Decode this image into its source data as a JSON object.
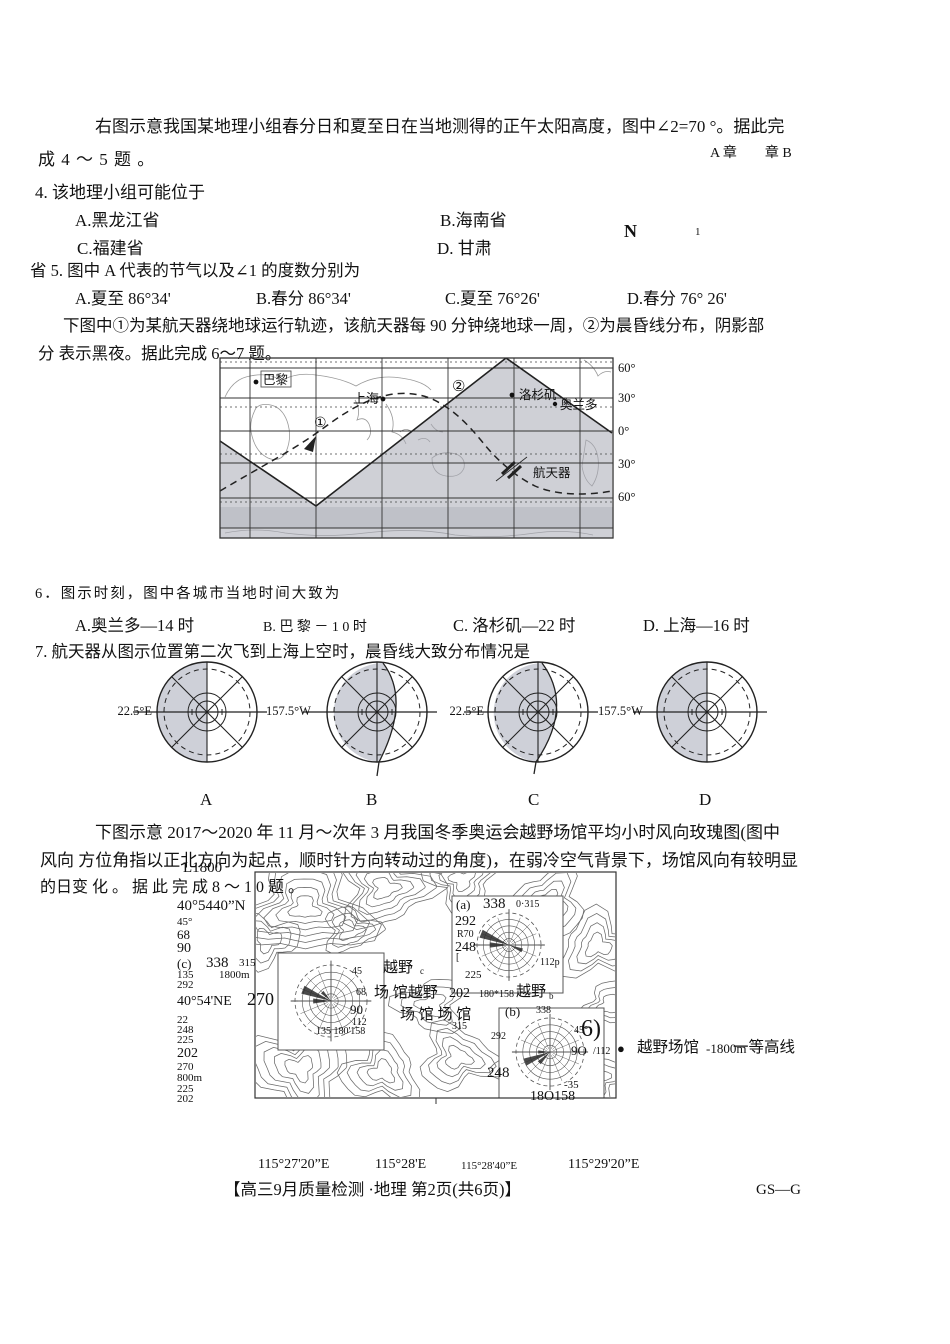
{
  "intro45": {
    "line1": "右图示意我国某地理小组春分日和夏至日在当地测得的正午太阳高度，图中∠2=70 °。据此完",
    "line2": "成 4 ～ 5 题 。"
  },
  "remnants": {
    "ab": "A 章　　章 B",
    "n": "N",
    "one": "1"
  },
  "q4": {
    "stem": "4. 该地理小组可能位于",
    "a": "A.黑龙江省",
    "b": "B.海南省",
    "c": "C.福建省",
    "d": "D. 甘肃"
  },
  "q5": {
    "stem": "省 5. 图中 A 代表的节气以及∠1 的度数分别为",
    "a": "A.夏至   86°34'",
    "b": "B.春分   86°34'",
    "c": "C.夏至   76°26'",
    "d": "D.春分 76° 26'"
  },
  "intro67": {
    "line1": "下图中①为某航天器绕地球运行轨迹，该航天器每 90 分钟绕地球一周，②为晨昏线分布，阴影部",
    "line2": "分 表示黑夜。据此完成 6～7 题。"
  },
  "worldmap": {
    "lat": [
      "60°",
      "30°",
      "0°",
      "30°",
      "60°"
    ],
    "paris": "巴黎",
    "shanghai": "上海",
    "la": "洛杉矶",
    "orlando": "奥兰多",
    "craft": "航天器",
    "m1": "①",
    "m2": "②"
  },
  "q6": {
    "stem": "6．图示时刻，图中各城市当地时间大致为",
    "a": "A.奥兰多—14 时",
    "b": "B. 巴 黎 － 1 0 时",
    "c": "C. 洛杉矶—22 时",
    "d": "D. 上海—16 时"
  },
  "q7": {
    "stem": "7. 航天器从图示位置第二次飞到上海上空时，晨昏线大致分布情况是",
    "opts": [
      {
        "lon": "22.5°E",
        "letter": "A"
      },
      {
        "lon": "157.5°W",
        "letter": "B"
      },
      {
        "lon": "22.5°E",
        "letter": "C"
      },
      {
        "lon": "157.5°W",
        "letter": "D"
      }
    ]
  },
  "intro810": {
    "line1": "下图示意 2017～2020 年 11 月～次年 3 月我国冬季奥运会越野场馆平均小时风向玫瑰图(图中",
    "line2": "风向 方位角指以正北方向为起点，顺时针方向转动过的角度)，在弱冷空气背景下，场馆风向有较明显",
    "line3": "的日变 化 。 据 此 完 成 8 ～ 1 0 题 。"
  },
  "contour": {
    "legend": {
      "dot": "●",
      "venue": "越野场馆",
      "elev": "-1800m",
      "line_label": "一等高线"
    },
    "scatter": [
      {
        "t": "L1800",
        "x": 183,
        "y": 859,
        "s": 15
      },
      {
        "t": "40°5440”N",
        "x": 177,
        "y": 897,
        "s": 15
      },
      {
        "t": "45°",
        "x": 177,
        "y": 916,
        "s": 11
      },
      {
        "t": "68",
        "x": 177,
        "y": 927,
        "s": 13
      },
      {
        "t": "90",
        "x": 177,
        "y": 940,
        "s": 14
      },
      {
        "t": "(c)",
        "x": 177,
        "y": 956,
        "s": 13
      },
      {
        "t": "338",
        "x": 206,
        "y": 954,
        "s": 15
      },
      {
        "t": "315",
        "x": 239,
        "y": 957,
        "s": 11
      },
      {
        "t": "135",
        "x": 177,
        "y": 969,
        "s": 11
      },
      {
        "t": "1800m",
        "x": 219,
        "y": 969,
        "s": 11
      },
      {
        "t": "292",
        "x": 177,
        "y": 979,
        "s": 11
      },
      {
        "t": "40°54'NE",
        "x": 177,
        "y": 993,
        "s": 14
      },
      {
        "t": "270",
        "x": 247,
        "y": 988,
        "s": 18
      },
      {
        "t": "22",
        "x": 177,
        "y": 1014,
        "s": 11
      },
      {
        "t": "248",
        "x": 177,
        "y": 1024,
        "s": 11
      },
      {
        "t": "225",
        "x": 177,
        "y": 1034,
        "s": 11
      },
      {
        "t": "202",
        "x": 177,
        "y": 1045,
        "s": 14
      },
      {
        "t": "270",
        "x": 177,
        "y": 1061,
        "s": 11
      },
      {
        "t": "800m",
        "x": 177,
        "y": 1072,
        "s": 11
      },
      {
        "t": "225",
        "x": 177,
        "y": 1083,
        "s": 11
      },
      {
        "t": "202",
        "x": 177,
        "y": 1093,
        "s": 11
      },
      {
        "t": "45",
        "x": 352,
        "y": 966,
        "s": 10
      },
      {
        "t": "68",
        "x": 356,
        "y": 987,
        "s": 10
      },
      {
        "t": "90",
        "x": 350,
        "y": 1002,
        "s": 13
      },
      {
        "t": "112",
        "x": 352,
        "y": 1017,
        "s": 10
      },
      {
        "t": "135 180'158",
        "x": 316,
        "y": 1026,
        "s": 10
      },
      {
        "t": "越野",
        "x": 383,
        "y": 959,
        "s": 15
      },
      {
        "t": "c",
        "x": 420,
        "y": 966,
        "s": 9
      },
      {
        "t": "场 馆越野",
        "x": 374,
        "y": 984,
        "s": 15
      },
      {
        "t": "202",
        "x": 449,
        "y": 985,
        "s": 14
      },
      {
        "t": "180*158",
        "x": 479,
        "y": 989,
        "s": 10
      },
      {
        "t": "越野",
        "x": 516,
        "y": 983,
        "s": 15
      },
      {
        "t": "b",
        "x": 549,
        "y": 991,
        "s": 9
      },
      {
        "t": "场 馆 场 馆",
        "x": 400,
        "y": 1006,
        "s": 15
      },
      {
        "t": "315",
        "x": 452,
        "y": 1021,
        "s": 10
      },
      {
        "t": "(a)",
        "x": 456,
        "y": 897,
        "s": 13
      },
      {
        "t": "338",
        "x": 483,
        "y": 895,
        "s": 15
      },
      {
        "t": "0·315",
        "x": 516,
        "y": 899,
        "s": 10
      },
      {
        "t": "292",
        "x": 455,
        "y": 913,
        "s": 14
      },
      {
        "t": "R70",
        "x": 457,
        "y": 929,
        "s": 10
      },
      {
        "t": "248",
        "x": 455,
        "y": 939,
        "s": 14
      },
      {
        "t": "[",
        "x": 456,
        "y": 952,
        "s": 10
      },
      {
        "t": "225",
        "x": 465,
        "y": 969,
        "s": 11
      },
      {
        "t": "112p",
        "x": 540,
        "y": 957,
        "s": 10
      },
      {
        "t": "(b)",
        "x": 505,
        "y": 1004,
        "s": 13
      },
      {
        "t": "338",
        "x": 536,
        "y": 1005,
        "s": 10
      },
      {
        "t": "292",
        "x": 491,
        "y": 1031,
        "s": 10
      },
      {
        "t": "45°",
        "x": 574,
        "y": 1025,
        "s": 10
      },
      {
        "t": "6)",
        "x": 581,
        "y": 1014,
        "s": 24
      },
      {
        "t": "9O",
        "x": 571,
        "y": 1043,
        "s": 13
      },
      {
        "t": "/112",
        "x": 593,
        "y": 1046,
        "s": 10
      },
      {
        "t": "248",
        "x": 487,
        "y": 1064,
        "s": 15
      },
      {
        "t": "-35",
        "x": 564,
        "y": 1079,
        "s": 11
      },
      {
        "t": "18O158",
        "x": 530,
        "y": 1088,
        "s": 14
      }
    ]
  },
  "coords": [
    "115°27'20”E",
    "115°28'E",
    "115°28'40”E",
    "115°29'20”E"
  ],
  "footer": {
    "left": "【高三9月质量检测 ·地理  第2页(共6页)】",
    "right": "GS—G"
  }
}
